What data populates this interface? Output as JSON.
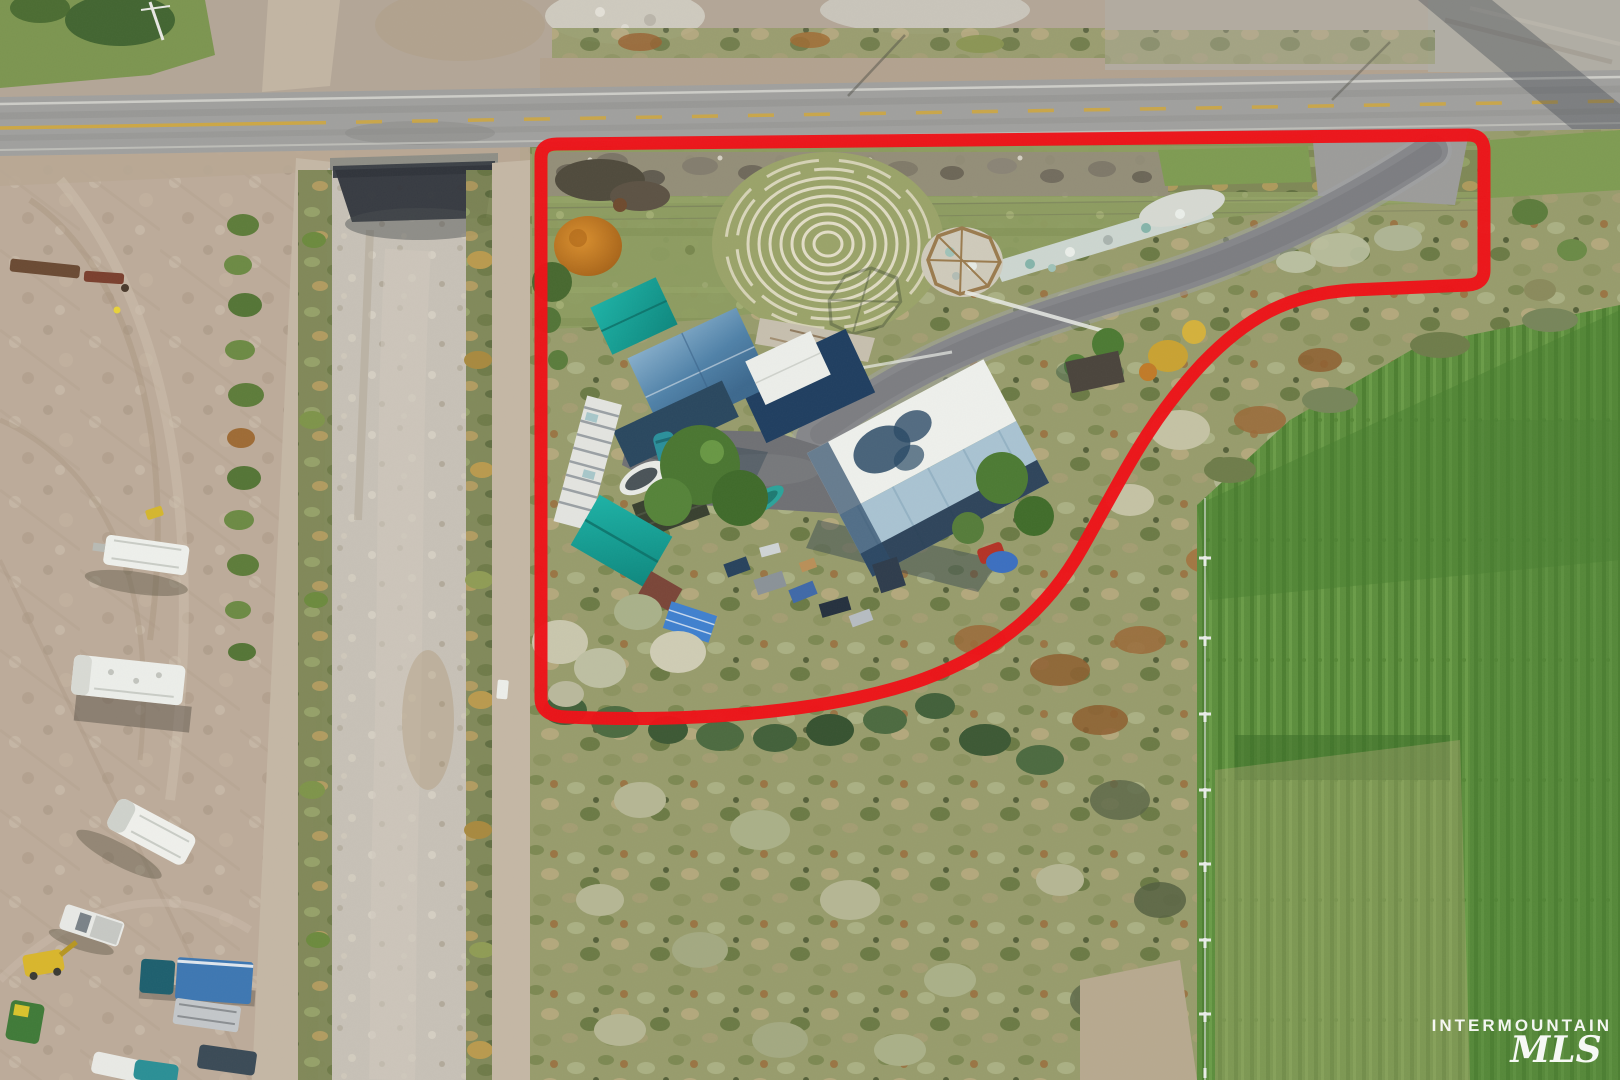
{
  "image": {
    "type": "aerial-drone-photograph",
    "subject": "rural acreage real-estate listing photo with red parcel outline",
    "view": "top-down"
  },
  "watermark": {
    "line1": "INTERMOUNTAIN",
    "line2": "MLS",
    "color": "#ffffff"
  },
  "annotations": {
    "parcel_outline_color": "#ee1117",
    "parcel_outline_shape": "rounded polygon, straight on north/west, S-curve on southeast"
  },
  "palette": {
    "boundary_red": "#ee1117",
    "watermark_white": "#ffffff",
    "road_asphalt": "#a0a09e",
    "dirt_light": "#bcab9a",
    "canal_gravel": "#c7c1b7",
    "scrub_olive": "#979c6c",
    "pasture_green": "#5c8e3d",
    "roof_steel_blue": "#4a7aa0",
    "roof_navy": "#1f3e60",
    "roof_white": "#eceeea",
    "shed_teal": "#12a297",
    "barn_roof_blue": "#a9c3d2",
    "tree_orange": "#cf8426"
  },
  "scene": {
    "landmarks": [
      "paved road along top with yellow center line",
      "irrigation canal and twin dirt roads running vertically at left",
      "dirt equipment yard with RVs, trailers and trucks at lower left",
      "stone labyrinth circle in lawn",
      "octagonal gazebo under construction with stone walkway",
      "house with steel-blue and white metal roof",
      "large shop barn with white / light-blue metal roof",
      "teal-roofed sheds, greenhouse, boats",
      "curved asphalt driveway to road",
      "green irrigated pasture with wire fence at right",
      "sagebrush scrub surrounding parcel"
    ]
  }
}
